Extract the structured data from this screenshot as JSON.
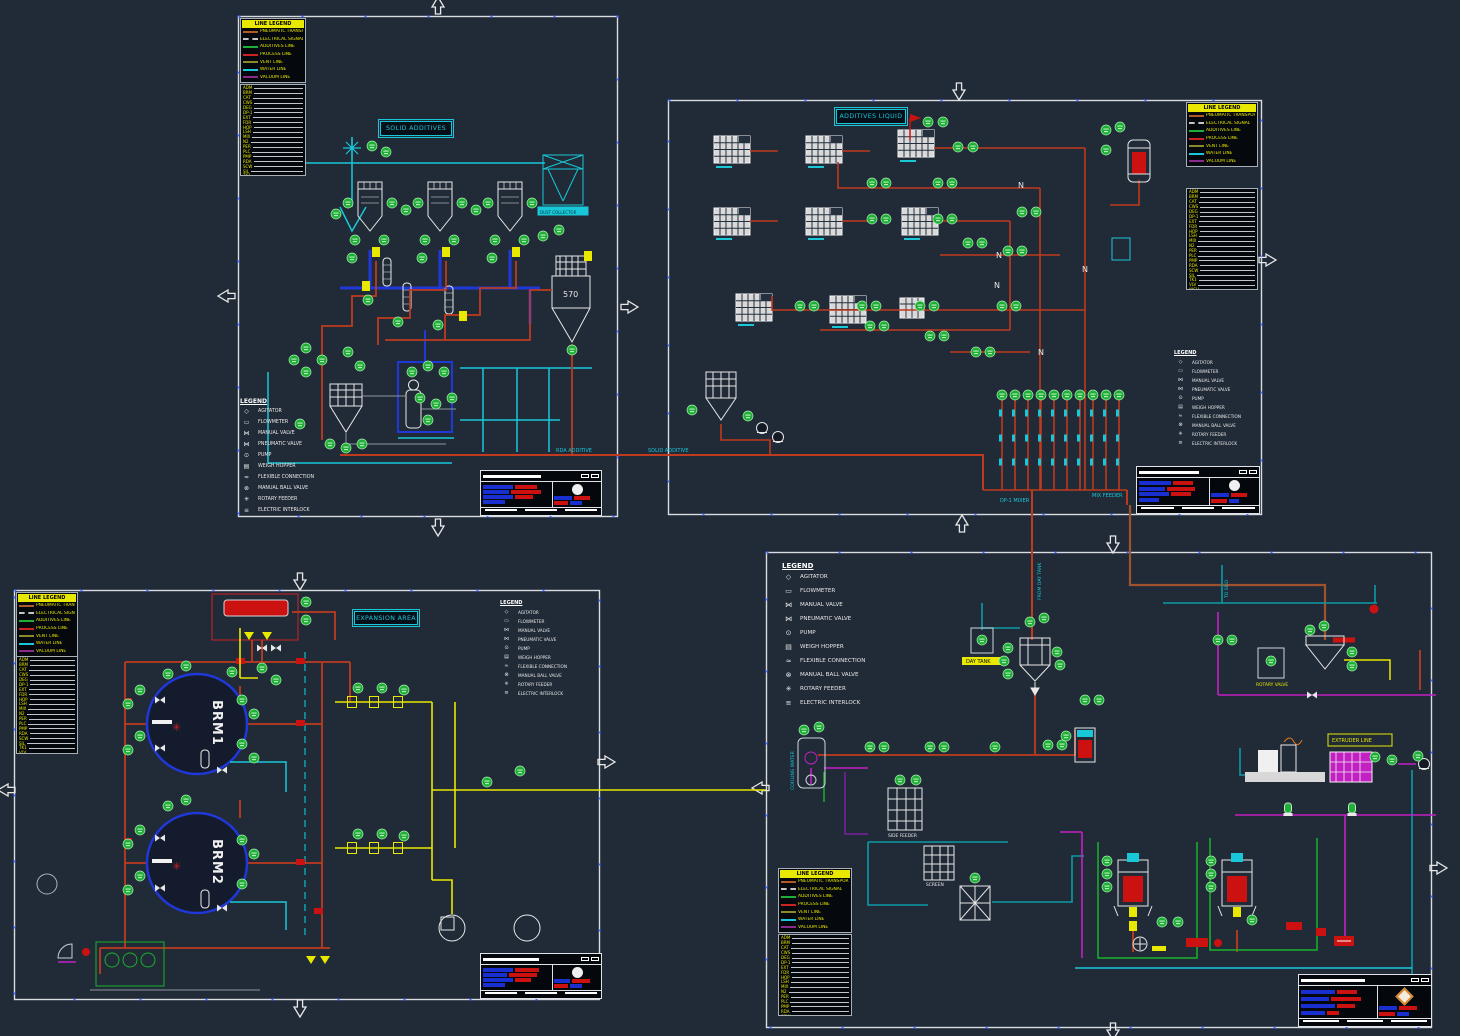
{
  "canvas": {
    "width": 1460,
    "height": 1036,
    "background": "#212a37"
  },
  "titles": {
    "solid": "SOLID ADDITIVES",
    "liquid": "ADDITIVES LIQUID",
    "expansion": "EXPANSION AREA"
  },
  "equipment": {
    "brm1": "BRM1",
    "brm2": "BRM2",
    "hopper_570": "570",
    "day_tank": "DAY TANK",
    "extruder": "EXTRUDER LINE",
    "dust_collector": "DUST COLLECTOR",
    "rotary_valve": "ROTARY VALVE",
    "side_feeder": "SIDE FEEDER",
    "screen": "SCREEN"
  },
  "pipe_labels": {
    "rda_additive": "RDA ADDITIVE",
    "solid_additive": "SOLID ADDITIVE",
    "dp1_mixer": "DP-1 MIXER",
    "mix_feeder": "MIX FEEDER",
    "from_day_tank": "FROM DAY TANK",
    "to_silo": "TO SILO",
    "cooling_water": "COOLING WATER",
    "n_marker": "N"
  },
  "line_legend": {
    "header": "LINE LEGEND",
    "rows": [
      {
        "color": "#b05a28",
        "style": "solid",
        "label": "PNEUMATIC TRANSPORT"
      },
      {
        "color": "#c4c4c4",
        "style": "dashed",
        "label": "ELECTRICAL SIGNAL"
      },
      {
        "color": "#1fae36",
        "style": "solid",
        "label": "ADDITIVES LINE"
      },
      {
        "color": "#cc2222",
        "style": "solid",
        "label": "PROCESS LINE"
      },
      {
        "color": "#8a8a2a",
        "style": "solid",
        "label": "VENT LINE"
      },
      {
        "color": "#19c8d8",
        "style": "solid",
        "label": "WATER LINE"
      },
      {
        "color": "#8a2a8a",
        "style": "solid",
        "label": "VACUUM LINE"
      }
    ]
  },
  "symbol_legend": {
    "header": "LEGEND",
    "rows": [
      {
        "glyph": "◇",
        "label": "AGITATOR"
      },
      {
        "glyph": "▭",
        "label": "FLOWMETER"
      },
      {
        "glyph": "⋈",
        "label": "MANUAL VALVE"
      },
      {
        "glyph": "⋈",
        "label": "PNEUMATIC VALVE"
      },
      {
        "glyph": "⊙",
        "label": "PUMP"
      },
      {
        "glyph": "▤",
        "label": "WEIGH HOPPER"
      },
      {
        "glyph": "≈",
        "label": "FLEXIBLE CONNECTION"
      },
      {
        "glyph": "⊗",
        "label": "MANUAL BALL VALVE"
      },
      {
        "glyph": "✳",
        "label": "ROTARY FEEDER"
      },
      {
        "glyph": "≡",
        "label": "ELECTRIC INTERLOCK"
      }
    ]
  },
  "abbreviations": [
    "ADM",
    "BRM",
    "CAT",
    "CWS",
    "DEG",
    "DP-1",
    "EXT",
    "FDR",
    "HOP",
    "LSH",
    "MIX",
    "N2",
    "PER",
    "PLC",
    "PMP",
    "RDA",
    "SCW",
    "SIL",
    "TK1",
    "VLV",
    "WGH",
    "XTR"
  ]
}
